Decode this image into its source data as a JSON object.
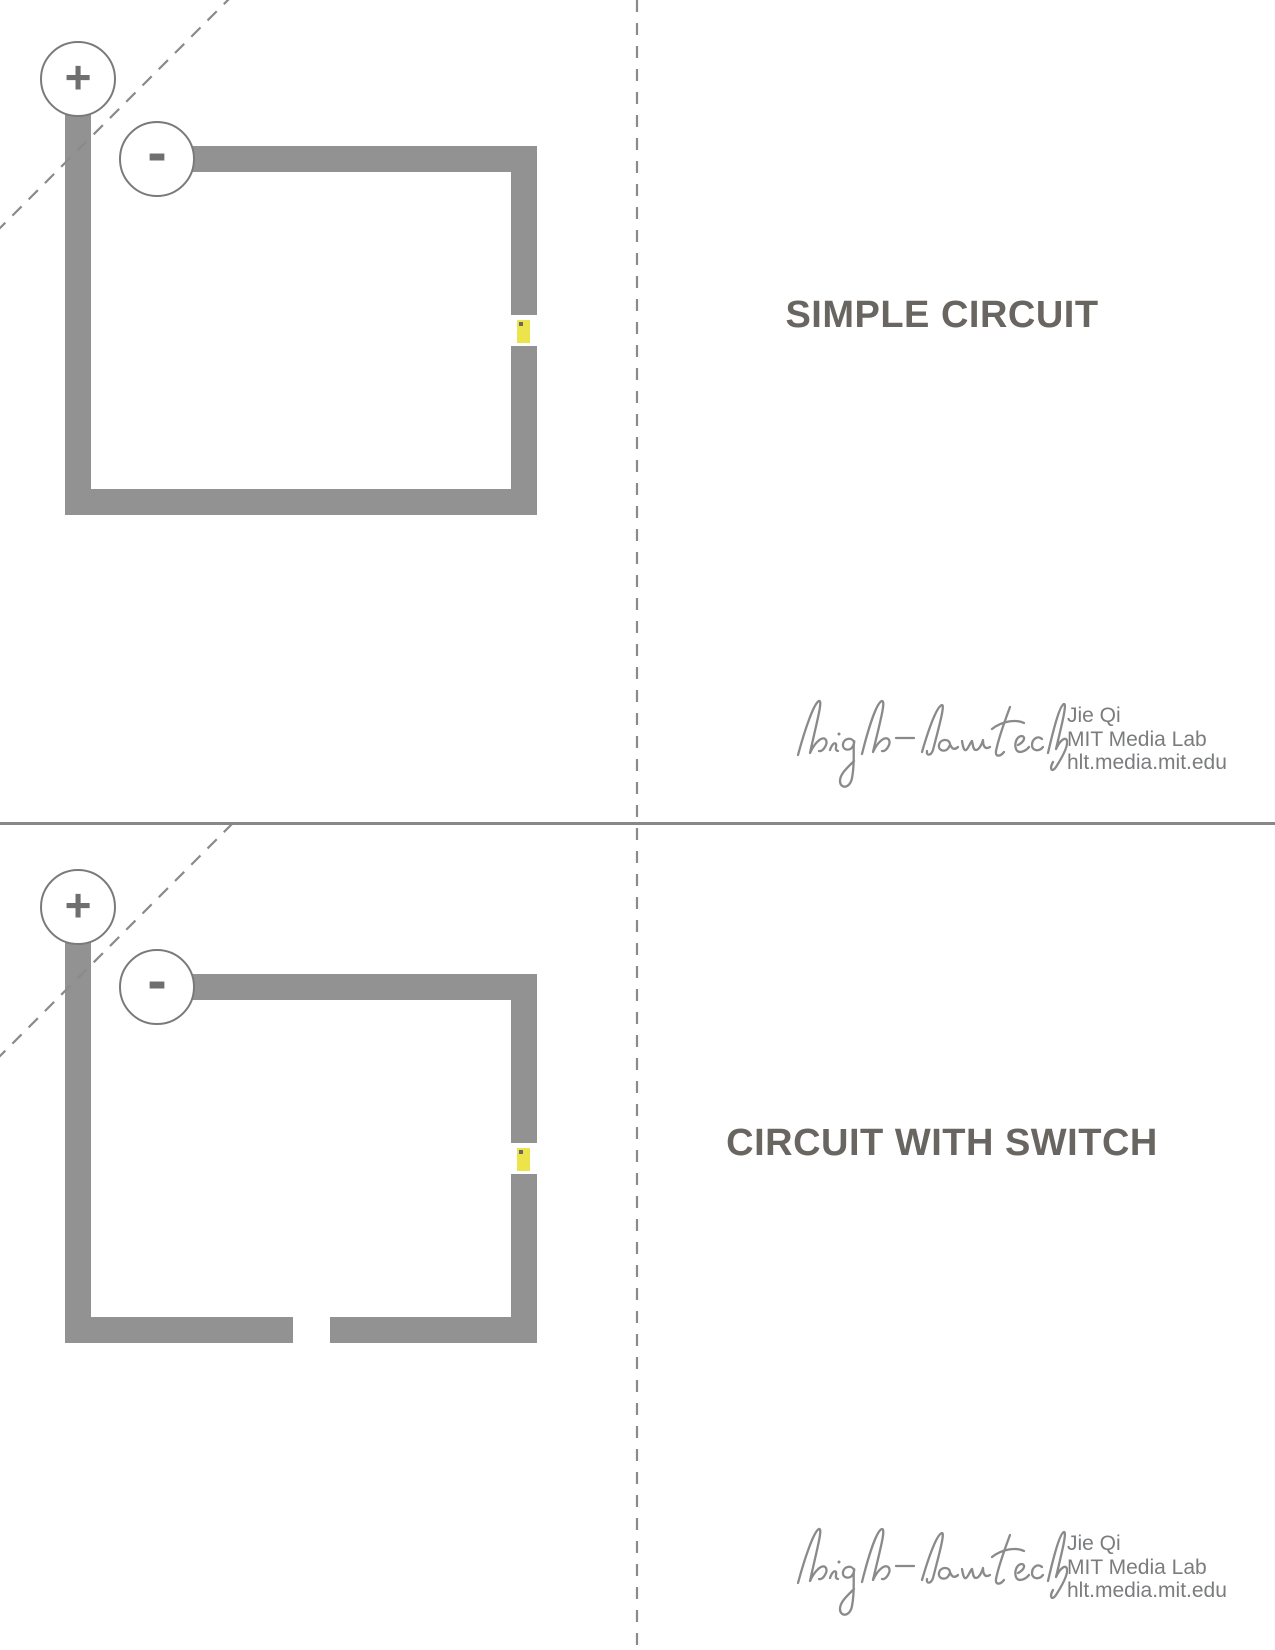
{
  "page": {
    "width": 1275,
    "height": 1650,
    "background": "#ffffff",
    "description": "Printable paper-circuit template sheet with two fold-and-cut circuit diagrams"
  },
  "colors": {
    "trace_gray": "#929292",
    "circle_stroke": "#7a7a7a",
    "terminal_sign": "#6f6f6f",
    "led_yellow": "#ece44a",
    "led_dot": "#676767",
    "title_text": "#696661",
    "credit_text": "#7b7c7e",
    "script_logo": "#8a8a8a",
    "fold_dash": "#8a8a8a",
    "divider": "#878787"
  },
  "icons": {
    "positive_terminal": "plus-circle",
    "negative_terminal": "minus-circle",
    "led": "yellow-led-sticker",
    "logo": "high-low-tech-handwritten-script"
  },
  "fold_lines": {
    "vertical_center_dashed_x": 637,
    "horizontal_divider_y": 823,
    "diagonal_corner_folds": 2
  },
  "sections": [
    {
      "title": "SIMPLE CIRCUIT",
      "battery": {
        "positive": "+",
        "negative": "-"
      },
      "has_switch_gap": false,
      "credit": {
        "logo": "high-low tech",
        "name": "Jie Qi",
        "org": "MIT Media Lab",
        "url": "hlt.media.mit.edu"
      }
    },
    {
      "title": "CIRCUIT WITH SWITCH",
      "battery": {
        "positive": "+",
        "negative": "-"
      },
      "has_switch_gap": true,
      "credit": {
        "logo": "high-low tech",
        "name": "Jie Qi",
        "org": "MIT Media Lab",
        "url": "hlt.media.mit.edu"
      }
    }
  ]
}
